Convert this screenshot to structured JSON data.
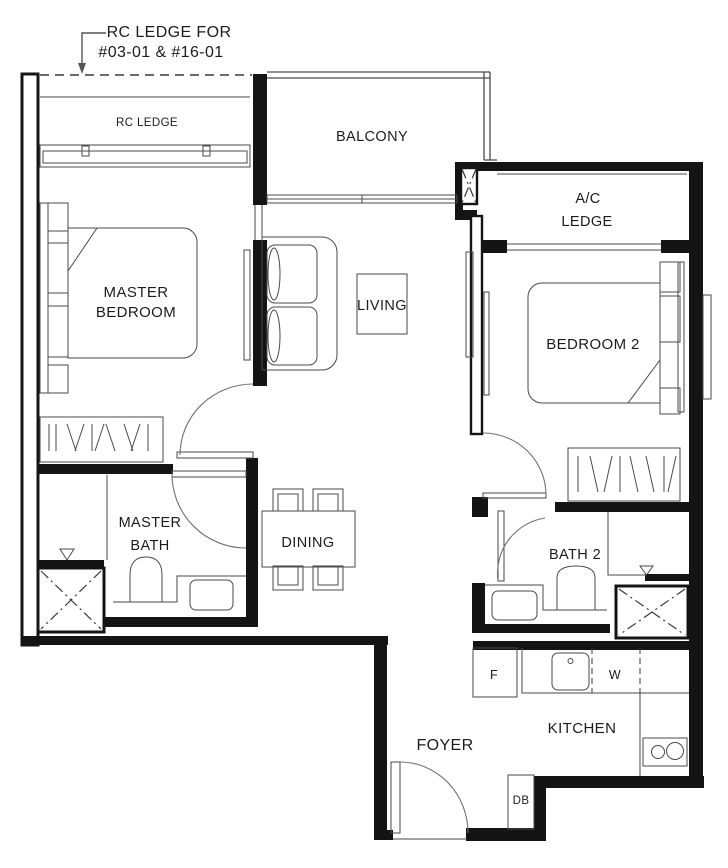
{
  "colors": {
    "wall": "#141414",
    "thin_line": "#4a4a4a",
    "background": "#ffffff",
    "text": "#1c1c1c"
  },
  "annotation": {
    "line1": "RC LEDGE FOR",
    "line2": "#03-01 & #16-01"
  },
  "rooms": {
    "rc_ledge": "RC LEDGE",
    "balcony": "BALCONY",
    "ac_ledge_line1": "A/C",
    "ac_ledge_line2": "LEDGE",
    "master_bedroom_line1": "MASTER",
    "master_bedroom_line2": "BEDROOM",
    "living": "LIVING",
    "bedroom2": "BEDROOM 2",
    "master_bath_line1": "MASTER",
    "master_bath_line2": "BATH",
    "dining": "DINING",
    "bath2": "BATH 2",
    "kitchen": "KITCHEN",
    "foyer": "FOYER"
  },
  "appliances": {
    "fridge": "F",
    "washer": "W",
    "distribution_board": "DB"
  }
}
